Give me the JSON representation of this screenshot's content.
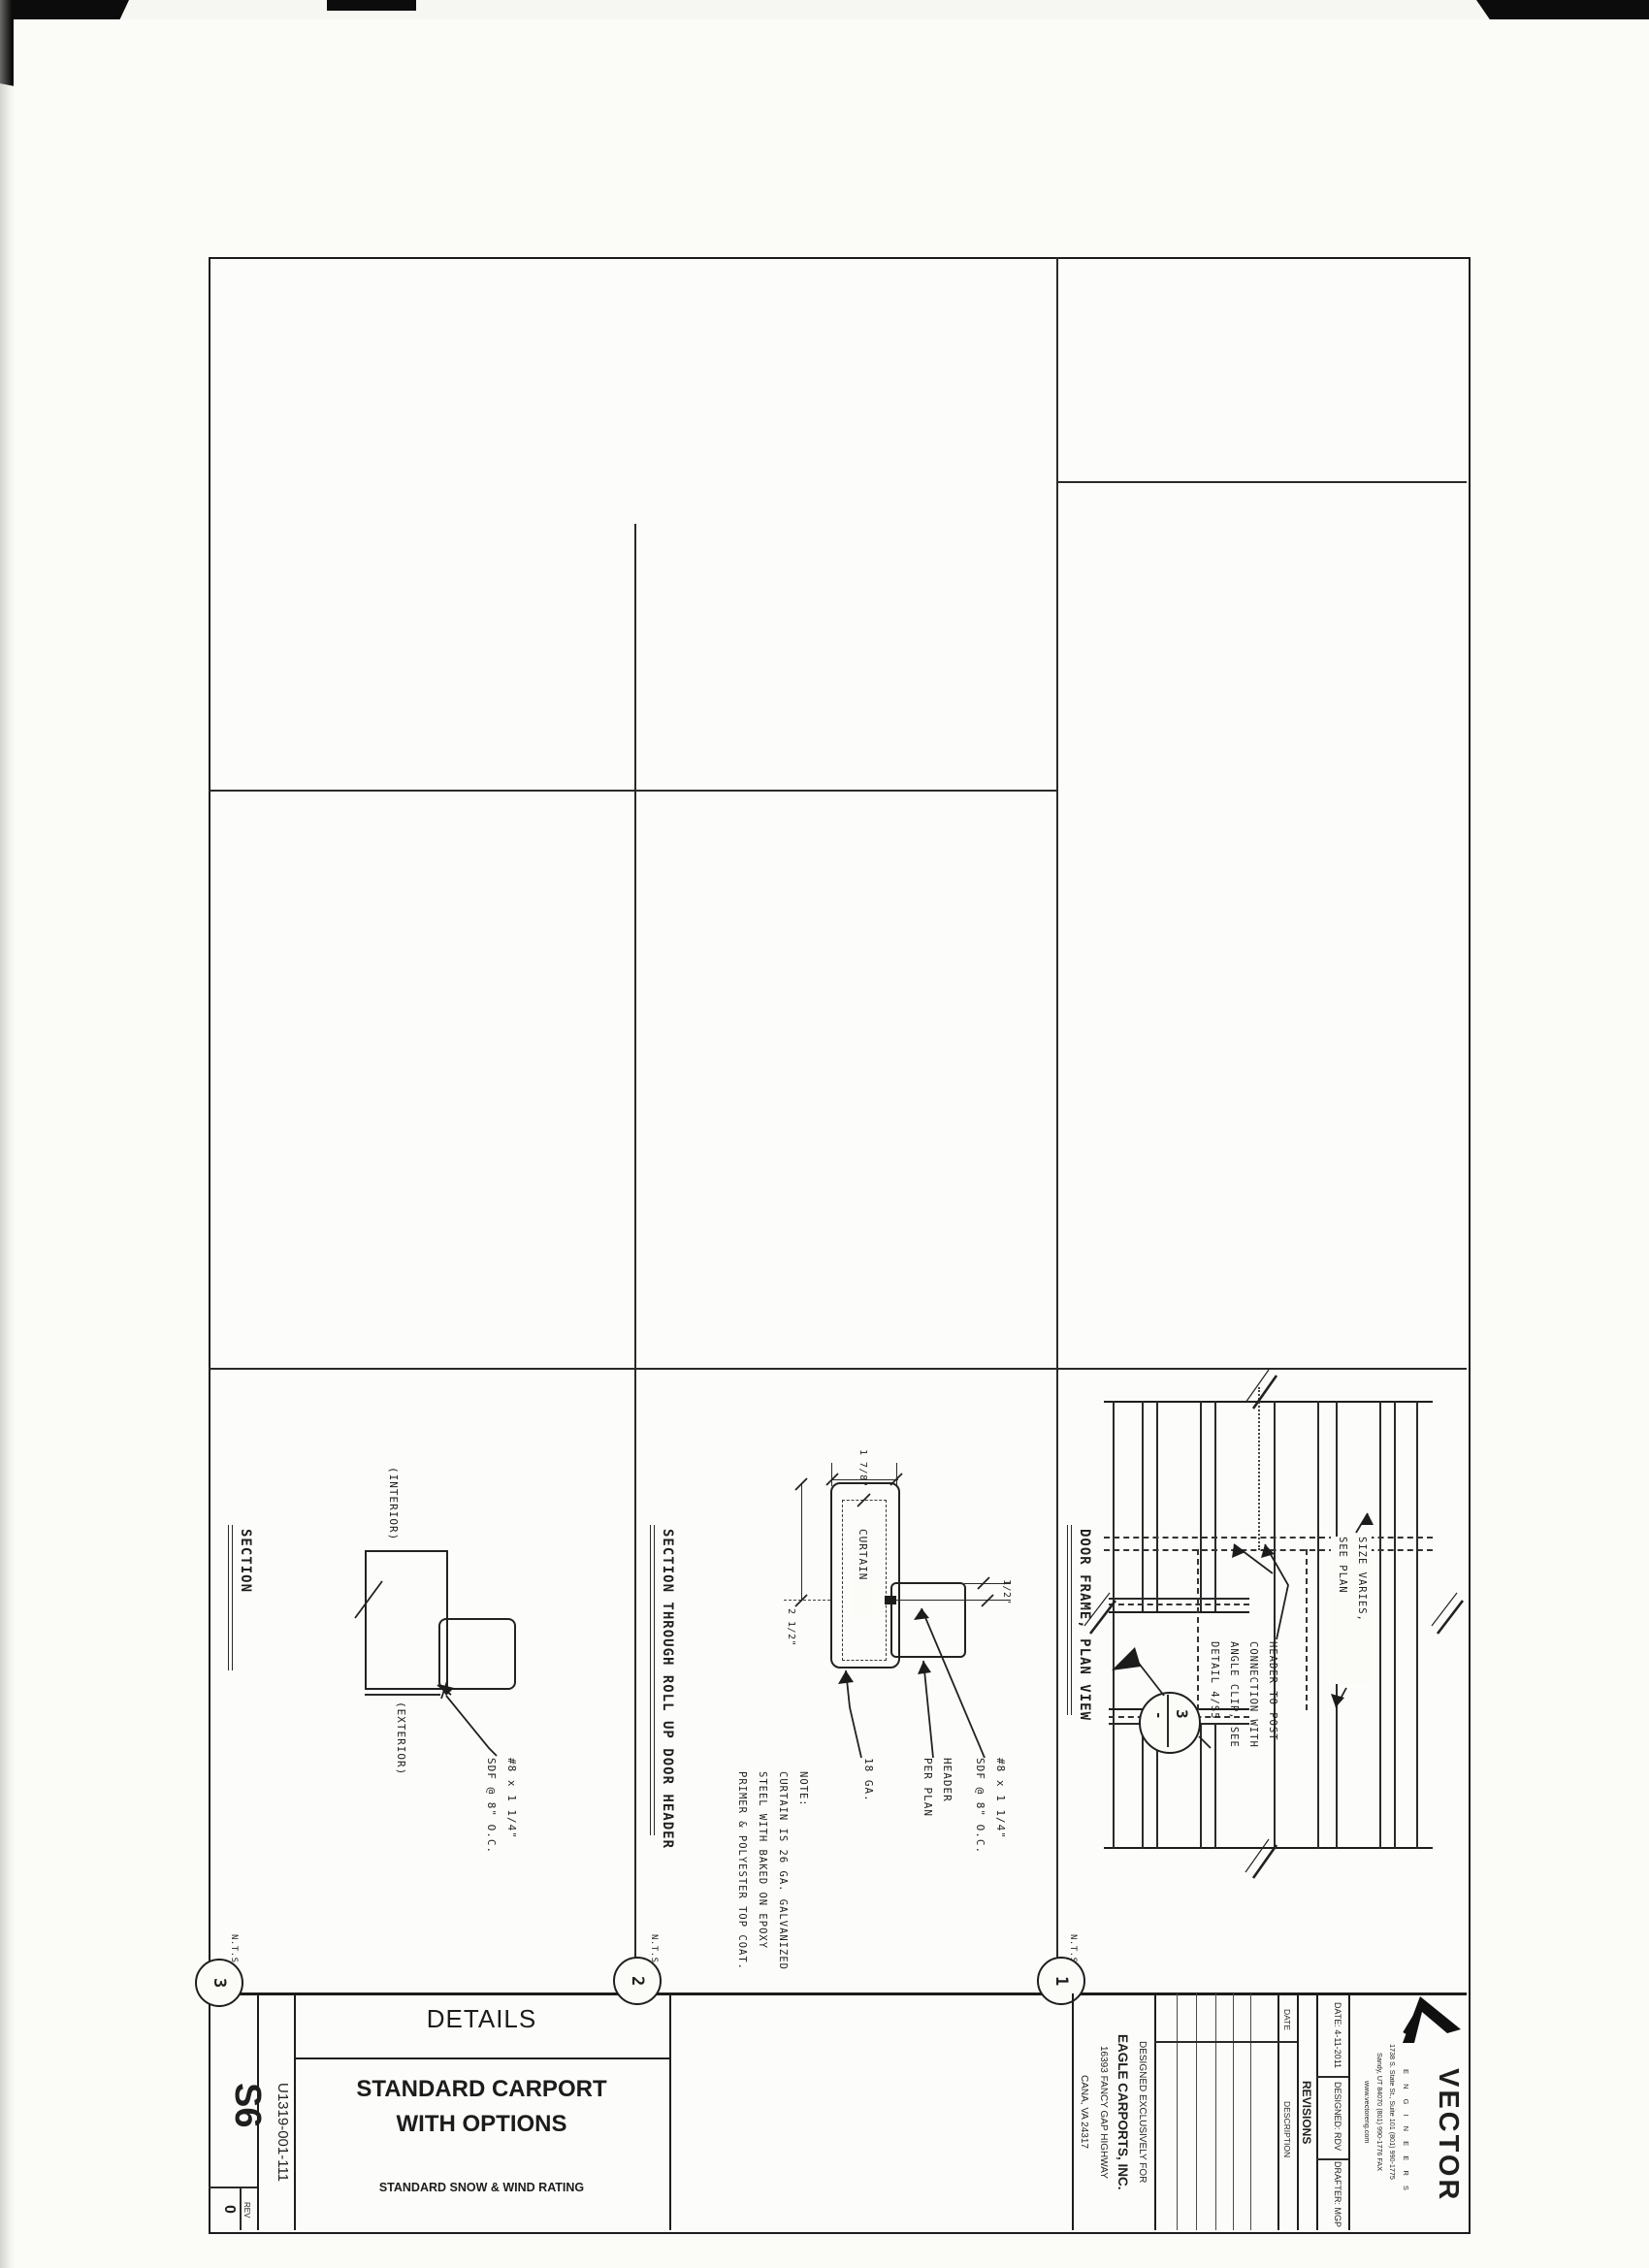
{
  "colors": {
    "paper": "#fbfbf8",
    "ink": "#1f1f1f"
  },
  "title_block": {
    "sheet_number": "S6",
    "drawing_number": "U1319-001-111",
    "rev_label": "REV",
    "rev_value": "0",
    "sheet_title": "DETAILS",
    "project_title_line1": "STANDARD CARPORT",
    "project_title_line2": "WITH OPTIONS",
    "rating_note": "STANDARD SNOW & WIND RATING",
    "client": {
      "lines": [
        "DESIGNED EXCLUSIVELY FOR",
        "EAGLE CARPORTS, INC.",
        "16393 FANCY GAP HIGHWAY",
        "CANA, VA 24317"
      ]
    },
    "revisions": {
      "title": "REVISIONS",
      "date_col": "DATE",
      "description_col": "DESCRIPTION"
    },
    "stamp": {
      "date": "DATE: 4-11-2011",
      "designed": "DESIGNED: RDV",
      "drafter": "DRAFTER: MGP"
    },
    "firm": {
      "name": "VECTOR",
      "tagline": "E N G I N E E R S",
      "address_phone_line1": "1738 S. State St., Suite 101   (801) 990-1775",
      "address_phone_line2": "Sandy, UT 84070   (801) 990-1776 FAX",
      "website": "www.vectoreng.com"
    }
  },
  "details": {
    "d1": {
      "number": "1",
      "title": "DOOR FRAME, PLAN VIEW",
      "scale": "N.T.S.",
      "callout_lines": [
        "HEADER TO POST",
        "CONNECTION WITH",
        "ANGLE CLIP, SEE",
        "DETAIL 4/S5"
      ],
      "size_lines": [
        "SIZE VARIES,",
        "SEE PLAN"
      ],
      "bubble_number": "3",
      "bubble_ref": "-"
    },
    "d2": {
      "number": "2",
      "title": "SECTION THROUGH ROLL UP DOOR HEADER",
      "scale": "N.T.S.",
      "dim_width": "1 7/8\"",
      "dim_depth": "2 1/2\"",
      "dim_gap": "1/2\"",
      "curtain_label": "CURTAIN",
      "gauge_label": "18 GA.",
      "header_lines": [
        "HEADER",
        "PER PLAN"
      ],
      "fastener_lines": [
        "#8 x 1 1/4\"",
        "SDF @ 8\" O.C."
      ],
      "note_lines": [
        "NOTE:",
        "CURTAIN IS 26 GA. GALVANIZED",
        "STEEL WITH BAKED ON EPOXY",
        "PRIMER & POLYESTER TOP COAT."
      ]
    },
    "d3": {
      "number": "3",
      "title": "SECTION",
      "scale": "N.T.S.",
      "interior_label": "(INTERIOR)",
      "exterior_label": "(EXTERIOR)",
      "fastener_lines": [
        "#8 x 1 1/4\"",
        "SDF @ 8\" O.C."
      ]
    }
  }
}
